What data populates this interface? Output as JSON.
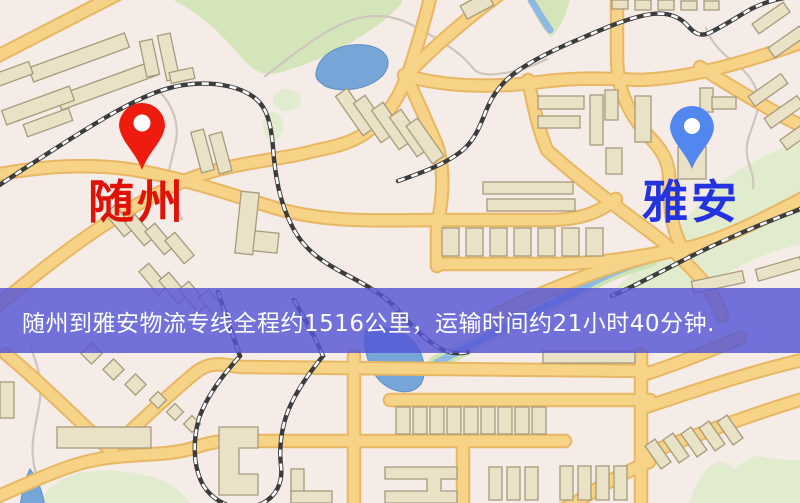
{
  "markers": {
    "origin": {
      "label": "随州",
      "text_color": "#e01208",
      "pin_color": "#ee1c0e"
    },
    "destination": {
      "label": "雅安",
      "text_color": "#2433e0",
      "pin_color": "#5387f0"
    }
  },
  "banner": {
    "text": "随州到雅安物流专线全程约1516公里，运输时间约21小时40分钟.",
    "background_color": "#5656d6",
    "text_color": "#ffffff"
  },
  "map_colors": {
    "background": "#f5ece7",
    "road": "#f7d387",
    "road_casing": "#e7b763",
    "building": "#eae2c6",
    "green": "#d5e5ba",
    "water": "#76a5d7",
    "railway": "#3c3c3c"
  }
}
